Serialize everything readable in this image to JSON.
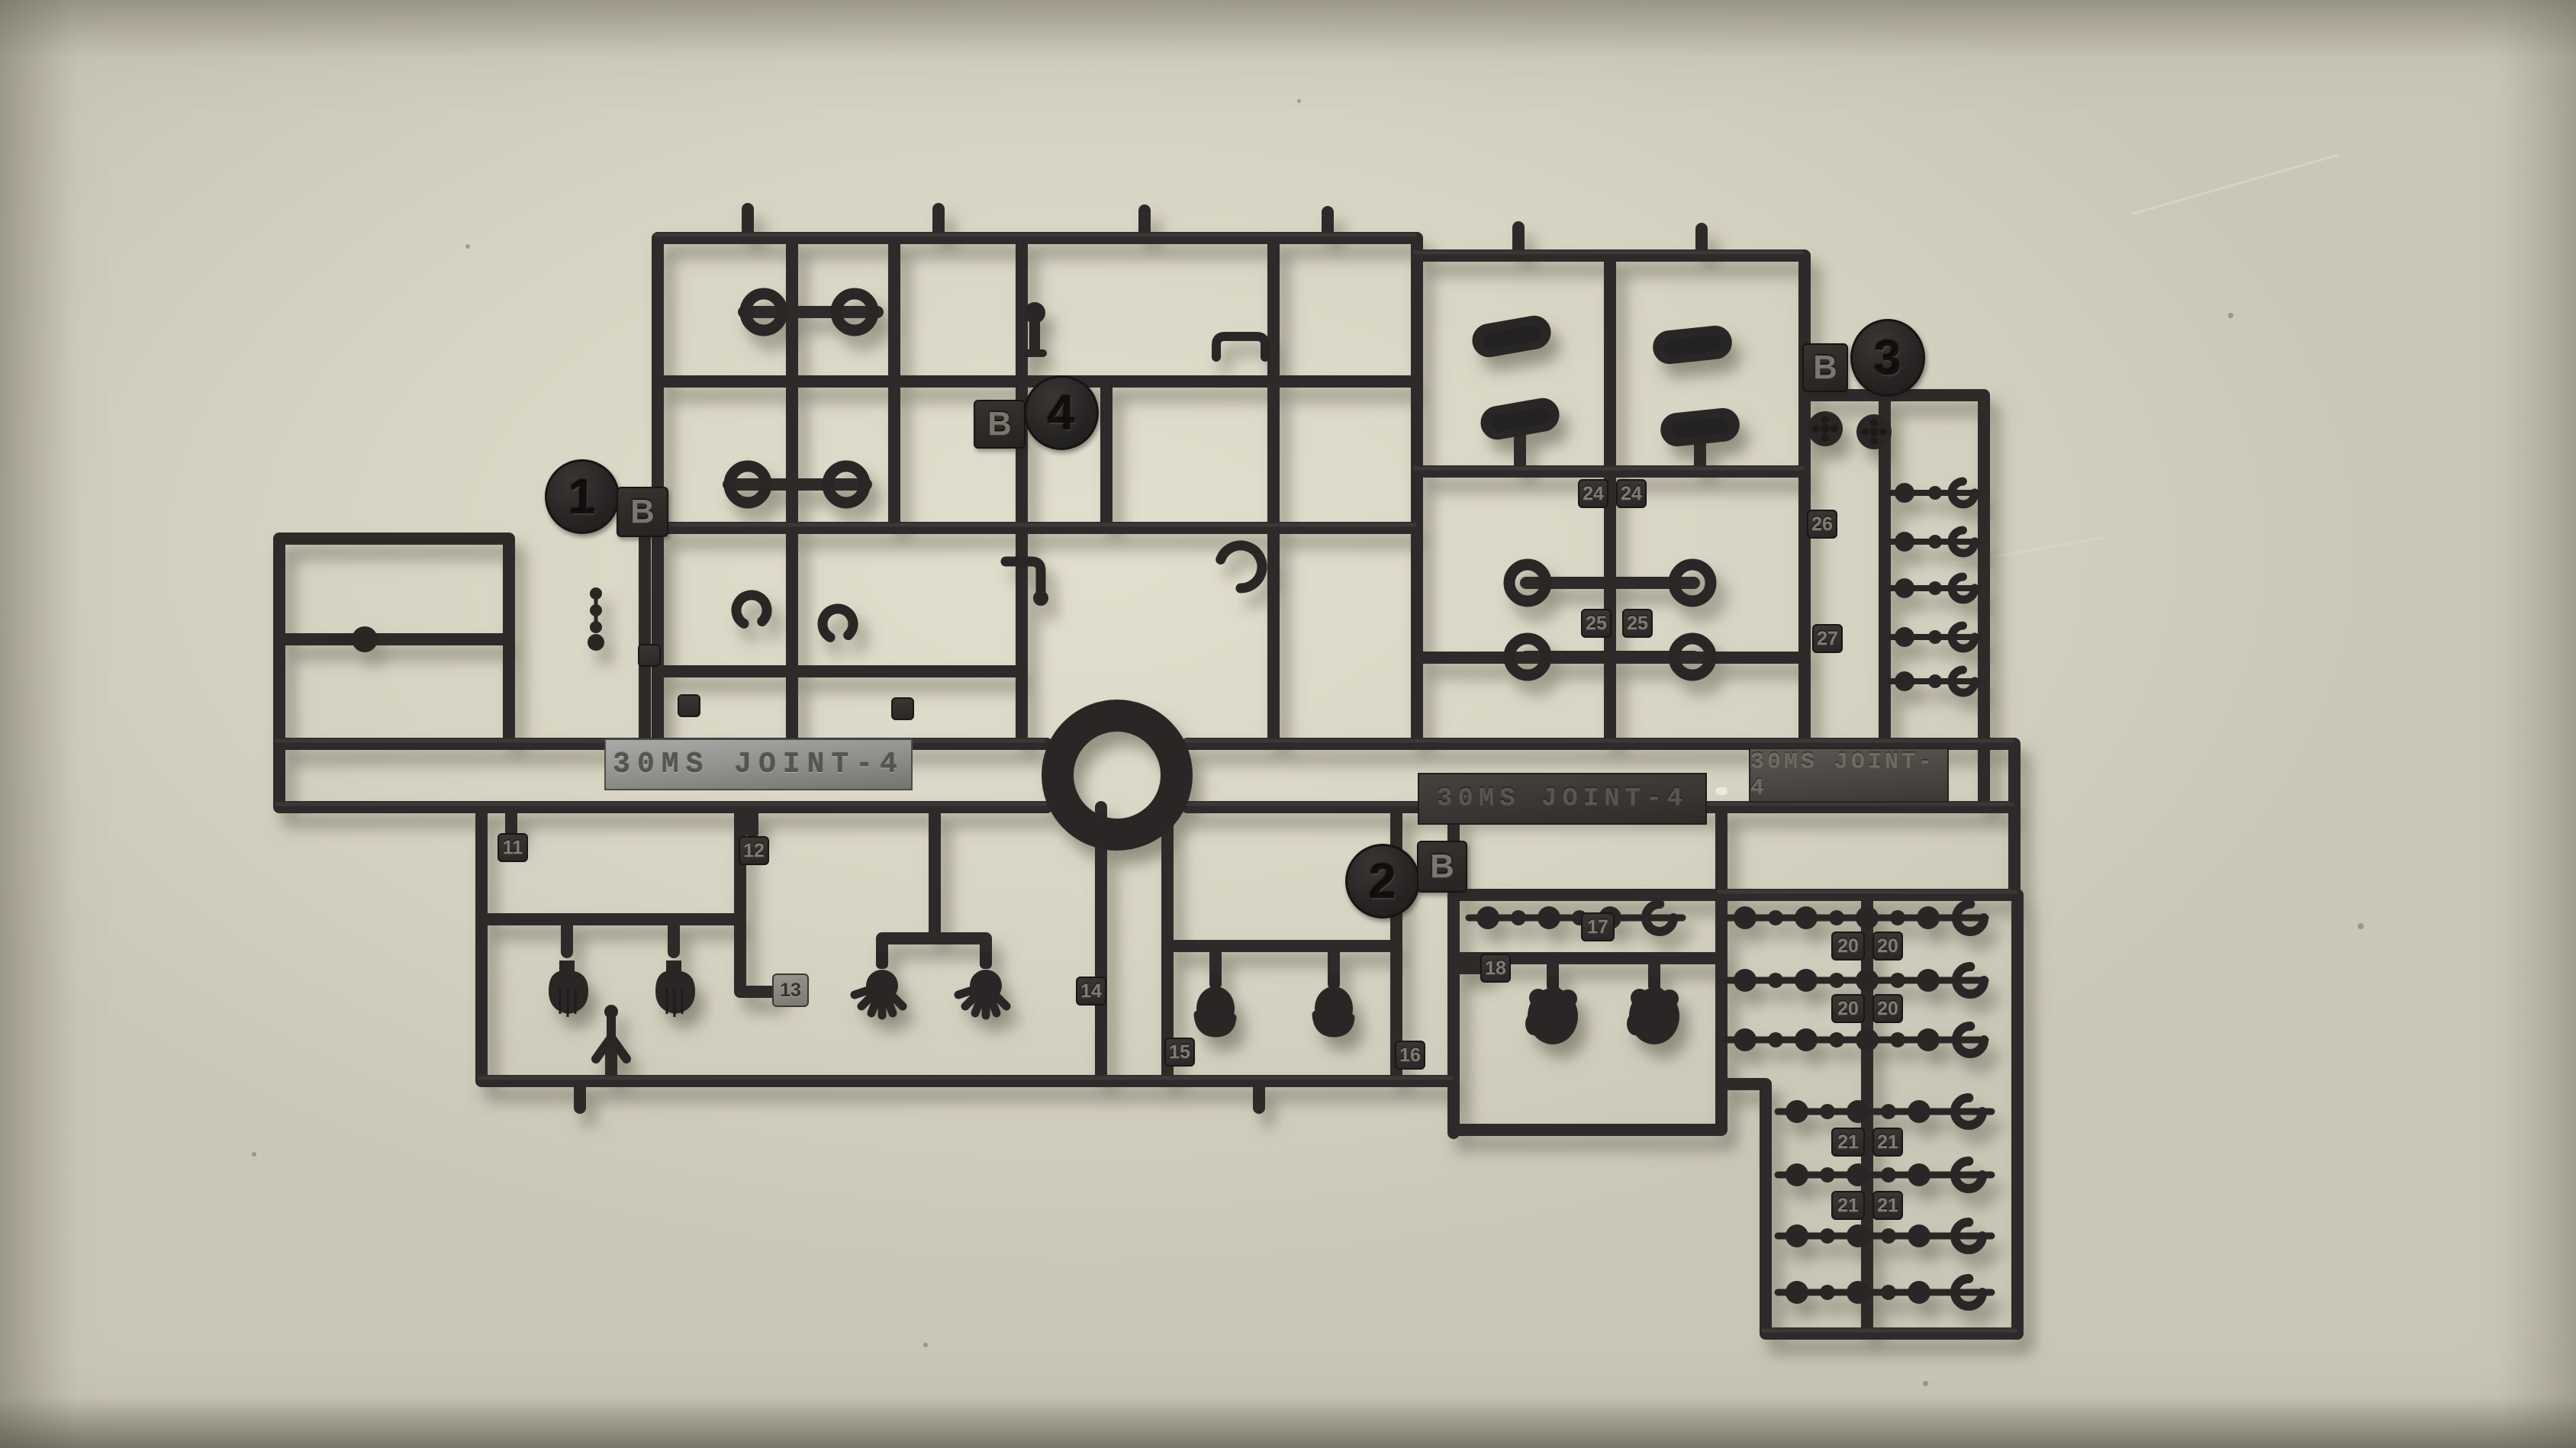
{
  "scene": {
    "subject": "Black injection-molded model kit runner (sprue) lying on a beige desk",
    "kit_name": "30MS JOINT-4",
    "desk_color": "#d8d4c2",
    "plastic_color": "#2c2a29",
    "silver_plate_color": "#96958f"
  },
  "plates": {
    "silver": "30MS JOINT-4",
    "center": "30MS JOINT-4",
    "right": "30MS JOINT-4"
  },
  "runner_markers": [
    {
      "number": "1",
      "material": "B"
    },
    {
      "number": "4",
      "material": "B"
    },
    {
      "number": "2",
      "material": "B"
    },
    {
      "number": "3",
      "material": "B"
    }
  ],
  "part_numbers": {
    "p11": "11",
    "p12": "12",
    "p13": "13",
    "p14": "14",
    "p15": "15",
    "p16": "16",
    "p17": "17",
    "p18": "18",
    "p20": "20",
    "p21": "21",
    "p24": "24",
    "p25": "25",
    "p26": "26",
    "p27": "27"
  },
  "parts_visible": [
    "open spread hands",
    "flat hands",
    "holding hands",
    "fists",
    "ball-joint link chains",
    "socket rings",
    "bean-shaped joint covers",
    "round joint discs",
    "elbow joints",
    "clip rings"
  ]
}
